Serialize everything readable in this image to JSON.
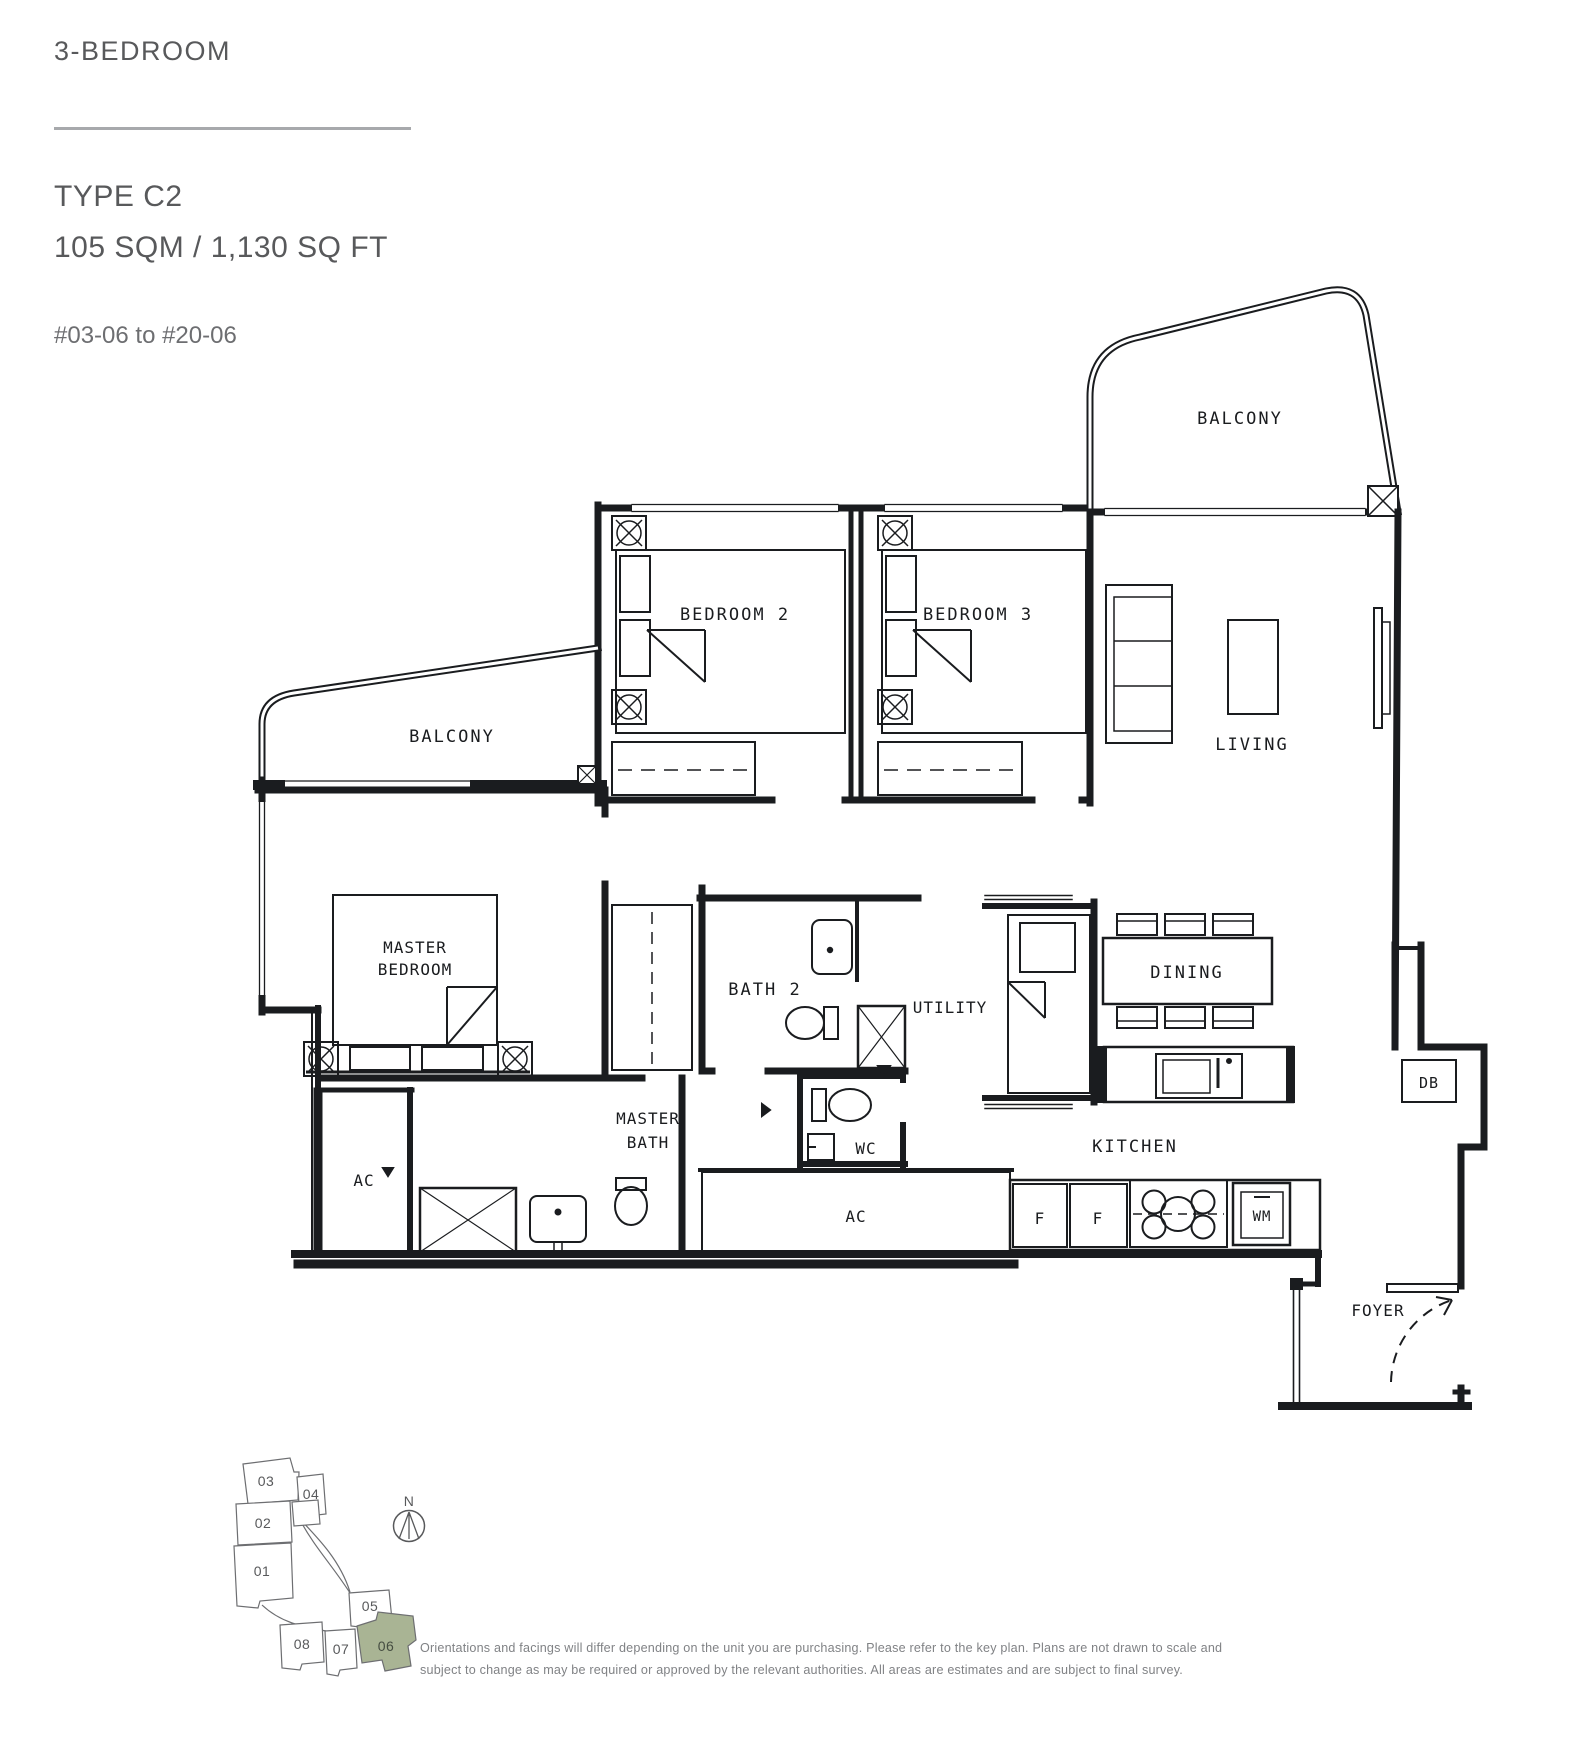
{
  "header": {
    "category": "3-BEDROOM",
    "type_name": "TYPE C2",
    "area": "105 SQM / 1,130 SQ FT",
    "unit_range": "#03-06 to #20-06"
  },
  "plan": {
    "rooms": {
      "balcony_top": "BALCONY",
      "balcony_left": "BALCONY",
      "bedroom2": "BEDROOM 2",
      "bedroom3": "BEDROOM 3",
      "living": "LIVING",
      "master_line1": "MASTER",
      "master_line2": "BEDROOM",
      "masterbath_line1": "MASTER",
      "masterbath_line2": "BATH",
      "bath2": "BATH 2",
      "utility": "UTILITY",
      "dining": "DINING",
      "kitchen": "KITCHEN",
      "wc": "WC",
      "foyer": "FOYER",
      "ac_left": "AC",
      "ac_center": "AC"
    },
    "fixtures": {
      "fridge1": "F",
      "fridge2": "F",
      "washer": "WM",
      "db": "DB"
    }
  },
  "key_plan": {
    "north": "N",
    "units": [
      "03",
      "04",
      "02",
      "01",
      "05",
      "08",
      "07",
      "06"
    ],
    "highlighted_unit": "06",
    "highlight_color": "#a9b494"
  },
  "disclaimer": {
    "line1": "Orientations and facings will differ depending on the unit you are purchasing. Please refer to the key plan. Plans are not drawn to scale and",
    "line2": "subject to change as may be required or approved by the relevant authorities. All areas are estimates and are subject to final survey."
  }
}
